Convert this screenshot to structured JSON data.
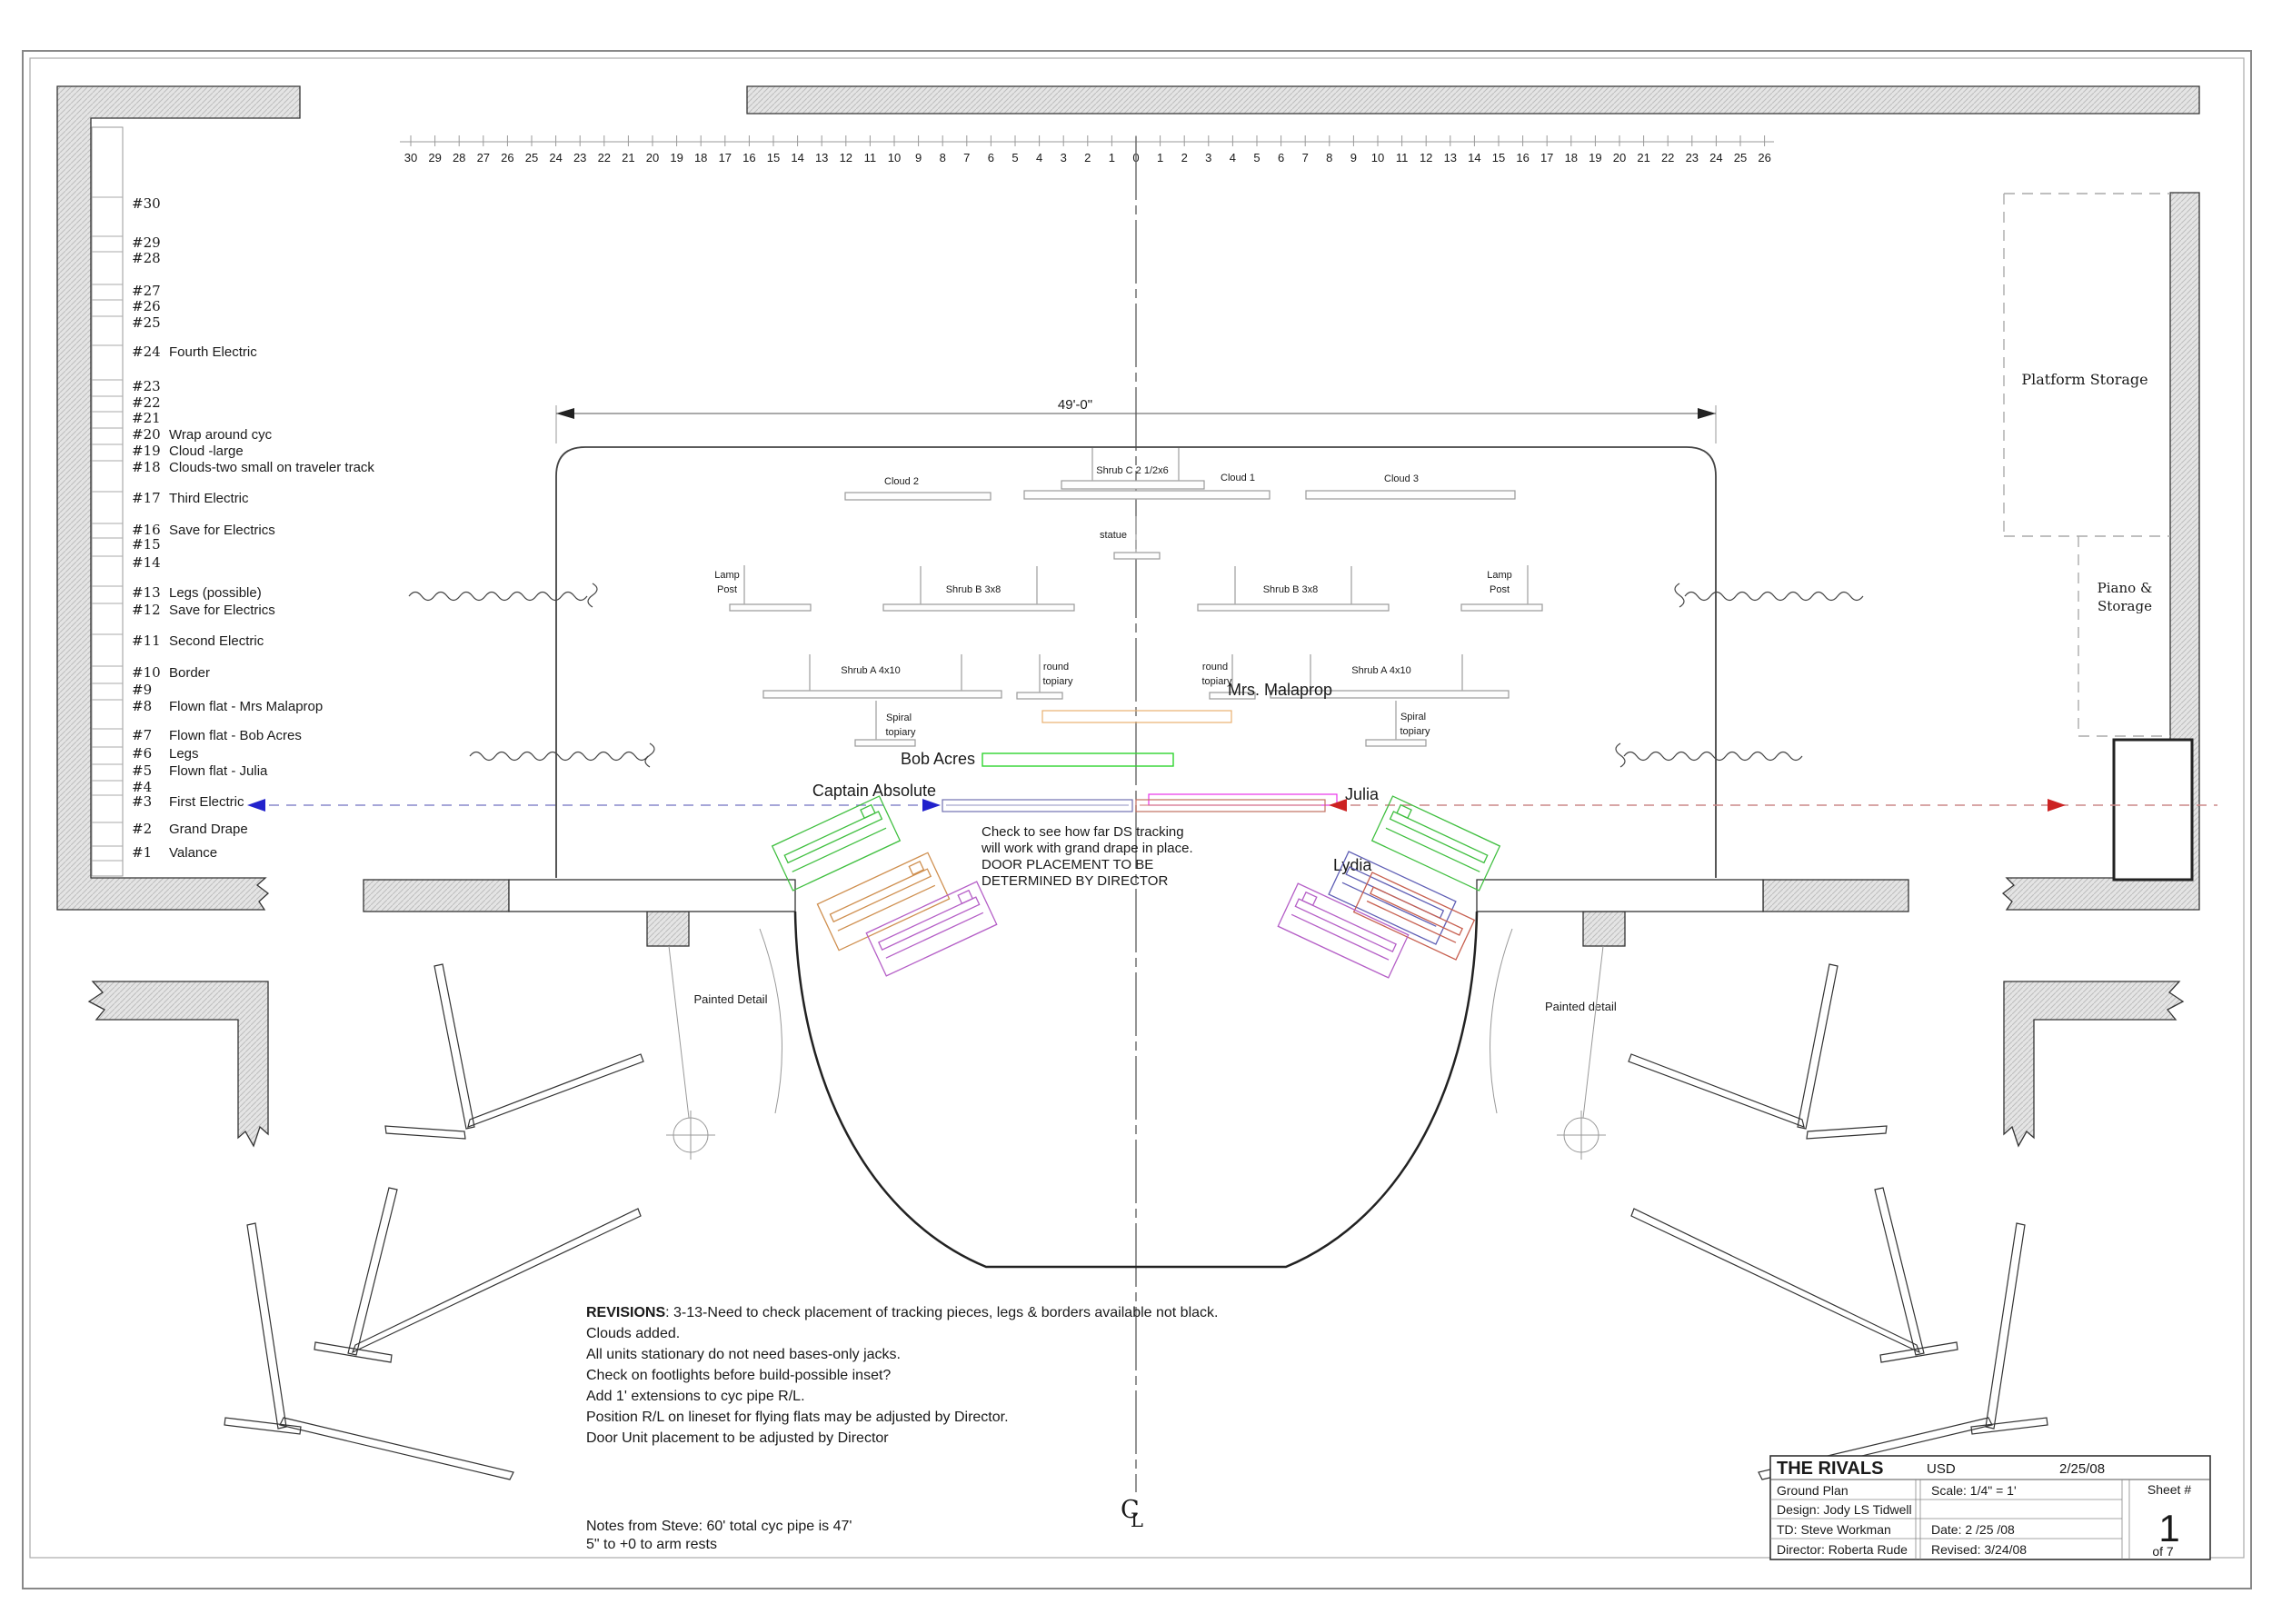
{
  "ruler": {
    "marks": [
      "30",
      "29",
      "28",
      "27",
      "26",
      "25",
      "24",
      "23",
      "22",
      "21",
      "20",
      "19",
      "18",
      "17",
      "16",
      "15",
      "14",
      "13",
      "12",
      "11",
      "10",
      "9",
      "8",
      "7",
      "6",
      "5",
      "4",
      "3",
      "2",
      "1",
      "0",
      "1",
      "2",
      "3",
      "4",
      "5",
      "6",
      "7",
      "8",
      "9",
      "10",
      "11",
      "12",
      "13",
      "14",
      "15",
      "16",
      "17",
      "18",
      "19",
      "20",
      "21",
      "22",
      "23",
      "24",
      "25",
      "26"
    ]
  },
  "linesets": [
    {
      "num": "#30",
      "label": ""
    },
    {
      "num": "#29",
      "label": ""
    },
    {
      "num": "#28",
      "label": ""
    },
    {
      "num": "#27",
      "label": ""
    },
    {
      "num": "#26",
      "label": ""
    },
    {
      "num": "#25",
      "label": ""
    },
    {
      "num": "#24",
      "label": "Fourth Electric"
    },
    {
      "num": "#23",
      "label": ""
    },
    {
      "num": "#22",
      "label": ""
    },
    {
      "num": "#21",
      "label": ""
    },
    {
      "num": "#20",
      "label": "Wrap around cyc"
    },
    {
      "num": "#19",
      "label": "Cloud -large"
    },
    {
      "num": "#18",
      "label": "Clouds-two small on traveler track"
    },
    {
      "num": "#17",
      "label": "Third Electric"
    },
    {
      "num": "#16",
      "label": "Save for Electrics"
    },
    {
      "num": "#15",
      "label": ""
    },
    {
      "num": "#14",
      "label": ""
    },
    {
      "num": "#13",
      "label": "Legs (possible)"
    },
    {
      "num": "#12",
      "label": "Save for Electrics"
    },
    {
      "num": "#11",
      "label": "Second Electric"
    },
    {
      "num": "#10",
      "label": "Border"
    },
    {
      "num": "#9",
      "label": ""
    },
    {
      "num": "#8",
      "label": "Flown flat - Mrs Malaprop"
    },
    {
      "num": "#7",
      "label": "Flown flat - Bob Acres"
    },
    {
      "num": "#6",
      "label": "Legs"
    },
    {
      "num": "#5",
      "label": "Flown flat - Julia"
    },
    {
      "num": "#4",
      "label": ""
    },
    {
      "num": "#3",
      "label": "First Electric"
    },
    {
      "num": "#2",
      "label": "Grand Drape"
    },
    {
      "num": "#1",
      "label": "Valance"
    }
  ],
  "stage": {
    "dimension_label": "49'-0\"",
    "scenic": {
      "cloud1": "Cloud 1",
      "cloud2": "Cloud 2",
      "cloud3": "Cloud 3",
      "shrub_c": "Shrub C 2 1/2x6",
      "statue": "statue",
      "lamp_line1": "Lamp",
      "lamp_line2": "Post",
      "shrub_b": "Shrub B 3x8",
      "shrub_a": "Shrub A 4x10",
      "round_line1": "round",
      "round_line2": "topiary",
      "spiral_line1": "Spiral",
      "spiral_line2": "topiary"
    }
  },
  "center_marker": {
    "top": "C",
    "bottom": "L"
  },
  "characters": {
    "mrs_malaprop": {
      "label": "Mrs. Malaprop",
      "color": "#e8882f",
      "bar_color": "#e8b070"
    },
    "bob_acres": {
      "label": "Bob Acres",
      "color": "#2fd42f",
      "bar_color": "#2fd42f"
    },
    "julia": {
      "label": "Julia",
      "color": "#e832e8",
      "bar_color": "#e832e8"
    },
    "captain_absolute": {
      "label": "Captain Absolute",
      "color": "#2525cc",
      "bar_color": "#7070b0"
    },
    "lydia": {
      "label": "Lydia",
      "color": "#e02020",
      "bar_color": "#c07060"
    }
  },
  "door_colors": {
    "green": "#3fbf3f",
    "tan": "#cf8f4f",
    "purple": "#b55fc7",
    "navy": "#5f5fb5",
    "red": "#c75f4f"
  },
  "director_note": {
    "color": "#e02020",
    "lines": [
      "Check to see how far DS  tracking",
      " will work with grand drape in place.",
      "DOOR PLACEMENT TO BE",
      " DETERMINED BY DIRECTOR"
    ]
  },
  "areas": {
    "platform_storage": "Platform Storage",
    "piano_line1": "Piano &",
    "piano_line2": "Storage",
    "painted_left": "Painted Detail",
    "painted_right": "Painted detail"
  },
  "revisions": {
    "title": "REVISIONS",
    "line1_rest": ": 3-13-Need to check placement of tracking pieces, legs & borders available not black.",
    "lines": [
      "Clouds added.",
      "All units stationary do not need bases-only jacks.",
      "Check on footlights before build-possible inset?",
      "Add 1' extensions to cyc pipe R/L.",
      "Position R/L on lineset for flying flats may be adjusted by Director.",
      "Door Unit placement to be adjusted by Director"
    ]
  },
  "notes": {
    "line1": "Notes from Steve: 60' total cyc pipe is 47'",
    "line2": "5\" to +0 to arm rests"
  },
  "title_block": {
    "show_title": "THE RIVALS",
    "company": "USD",
    "date_top": "2/25/08",
    "sheet_name": "Ground Plan",
    "scale": "Scale: 1/4\" = 1'",
    "design": "Design: Jody LS Tidwell",
    "td": "TD:  Steve Workman",
    "date": "Date:  2 /25 /08",
    "director": "Director: Roberta Rude",
    "revised": "Revised: 3/24/08",
    "sheet_label": "Sheet #",
    "sheet_number": "1",
    "sheet_of": "of  7"
  }
}
